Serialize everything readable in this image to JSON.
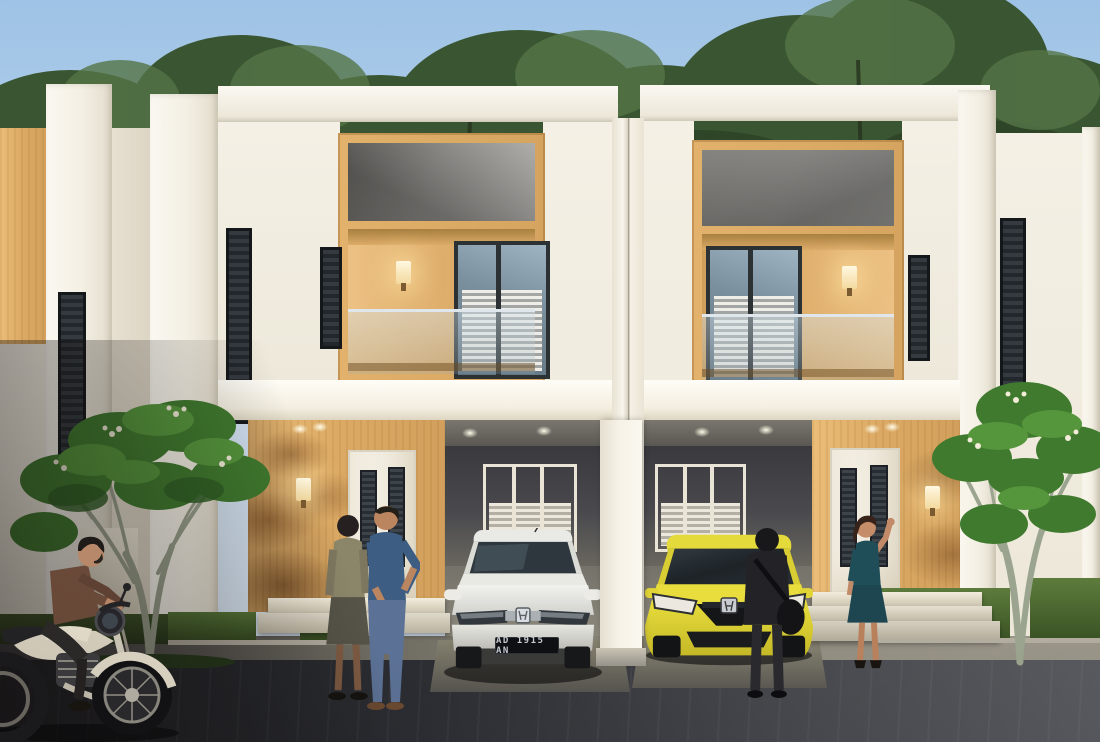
{
  "scene": {
    "title": "Modern two-story townhouse row — dusk architectural render",
    "license_plate": "AD 1915 AN"
  },
  "palette": {
    "sky_top": "#9ec3e6",
    "sky_bottom": "#dde8f3",
    "foliage_dark": "#2e4427",
    "foliage_light": "#557447",
    "wall_white": "#f6f3ea",
    "wood_facade": "#dcaa64",
    "concrete_recess": "#8d8c88",
    "carport_wall": "#46464a",
    "road_dark": "#24262a",
    "road_light": "#5a5c60",
    "car_white": "#e9e9e6",
    "car_yellow": "#ded32f",
    "dress_teal": "#1f4e58",
    "lamp_glow": "#ffe9b8",
    "grass": "#4d6b33"
  },
  "objects": {
    "left_house": "two-story townhouse unit (left)",
    "right_house": "two-story townhouse unit (right)",
    "white_car": "white sedan parked in left carport",
    "yellow_car": "yellow hatchback parked in right carport",
    "motorcycle": "man riding classic motorcycle",
    "couple_talking": "two people talking at left entrance",
    "visitor_with_bag": "person with shoulder bag beside yellow car",
    "waving_woman": "woman in teal dress waving at right entrance",
    "frangipani_trees": "frangipani trees in front yards",
    "background_trees": "dense foliage behind the houses"
  }
}
